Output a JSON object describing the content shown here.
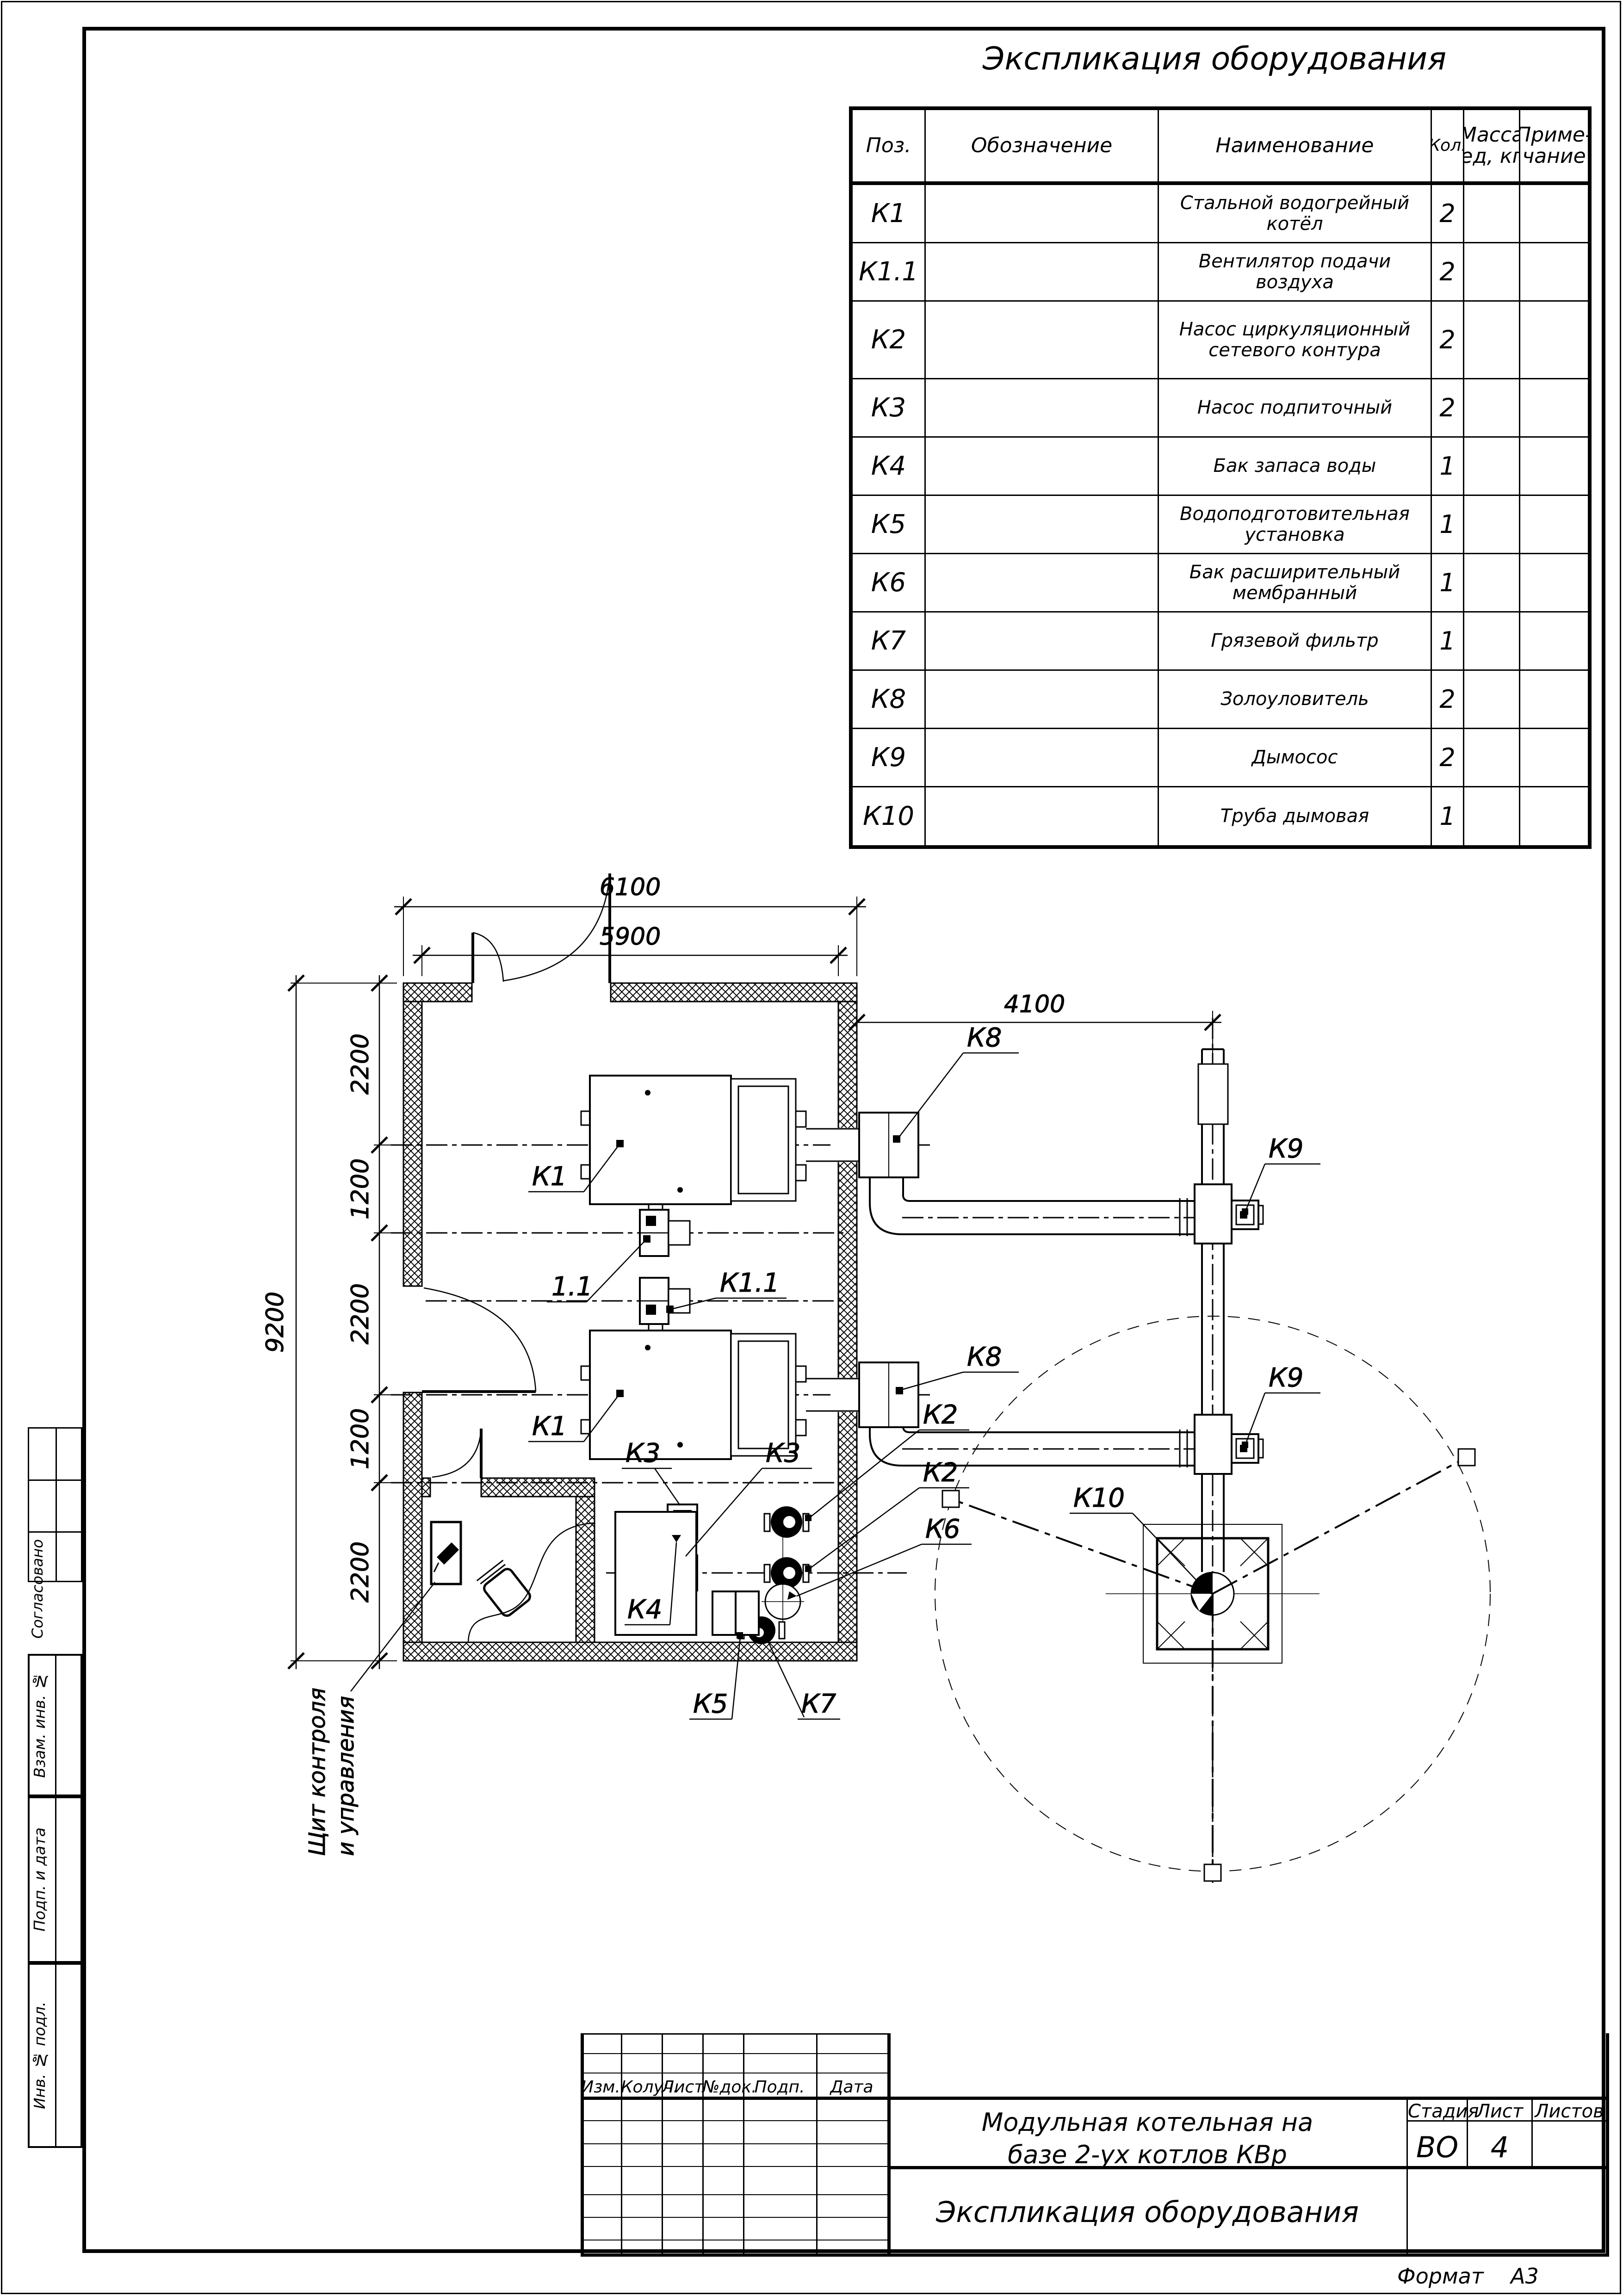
{
  "equipment_table": {
    "title": "Экспликация оборудования",
    "col_pos": "Поз.",
    "col_designation": "Обозначение",
    "col_name": "Наименование",
    "col_qty": "Кол.",
    "col_mass_l1": "Масса",
    "col_mass_l2": "ед, кг",
    "col_note_l1": "Приме-",
    "col_note_l2": "чание",
    "rows": [
      {
        "pos": "К1",
        "name": "Стальной водогрейный котёл",
        "qty": "2"
      },
      {
        "pos": "К1.1",
        "name": "Вентилятор подачи воздуха",
        "qty": "2"
      },
      {
        "pos": "К2",
        "name": "Насос циркуляционный сетевого контура",
        "qty": "2"
      },
      {
        "pos": "К3",
        "name": "Насос подпиточный",
        "qty": "2"
      },
      {
        "pos": "К4",
        "name": "Бак запаса воды",
        "qty": "1"
      },
      {
        "pos": "К5",
        "name": "Водоподготовительная установка",
        "qty": "1"
      },
      {
        "pos": "К6",
        "name": "Бак расширительный мембранный",
        "qty": "1"
      },
      {
        "pos": "К7",
        "name": "Грязевой фильтр",
        "qty": "1"
      },
      {
        "pos": "К8",
        "name": "Золоуловитель",
        "qty": "2"
      },
      {
        "pos": "К9",
        "name": "Дымосос",
        "qty": "2"
      },
      {
        "pos": "К10",
        "name": "Труба дымовая",
        "qty": "1"
      }
    ]
  },
  "title_block": {
    "rev_cols": [
      "Изм.",
      "Колуч.",
      "Лист",
      "№док.",
      "Подп.",
      "Дата"
    ],
    "doc_title_l1": "Модульная котельная на",
    "doc_title_l2": "базе 2-ух котлов КВр",
    "stage_label": "Стадия",
    "sheet_label": "Лист",
    "sheets_label": "Листов",
    "stage_value": "ВО",
    "sheet_value": "4",
    "sheets_value": "",
    "sheet_title": "Экспликация оборудования",
    "format_label": "Формат",
    "format_value": "А3"
  },
  "sidebar": {
    "agreed": "Согласовано",
    "vzam": "Взам. инв. №",
    "podp": "Подп. и дата",
    "inv": "Инв. № подл."
  },
  "plan": {
    "dim_6100": "6100",
    "dim_5900": "5900",
    "dim_4100": "4100",
    "dim_9200": "9200",
    "seg_1": "2200",
    "seg_2": "1200",
    "seg_3": "2200",
    "seg_4": "1200",
    "seg_5": "2200",
    "k1_top": "К1",
    "k1_bottom": "К1",
    "fan_tag": "1.1",
    "k11": "К1.1",
    "k2_top": "К2",
    "k2_bottom": "К2",
    "k3_left": "К3",
    "k3_right": "К3",
    "k4": "К4",
    "k5": "К5",
    "k6": "К6",
    "k7": "К7",
    "k8_top": "К8",
    "k8_bottom": "К8",
    "k9_top": "К9",
    "k9_bottom": "К9",
    "k10": "К10",
    "panel_l1": "Щит контроля",
    "panel_l2": "и управления"
  }
}
